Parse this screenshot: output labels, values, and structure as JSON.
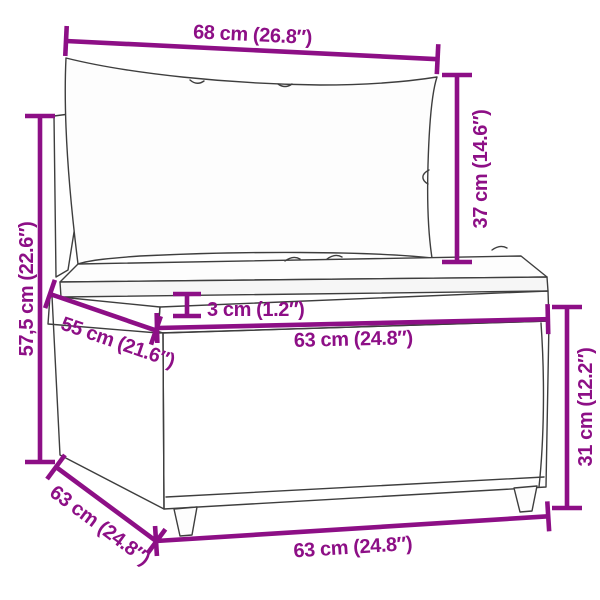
{
  "app": {
    "description": "Product dimension diagram of a poly-rattan sofa middle section with back and seat cushions"
  },
  "colors": {
    "dimension_accent": "#8d0f86",
    "sketch_line": "#3e3e3e",
    "background": "#ffffff"
  },
  "diagram": {
    "dimensions": {
      "top_width": "68 cm (26.8″)",
      "backrest_height": "37 cm (14.6″)",
      "total_height": "57,5 cm (22.6″)",
      "seat_cushion_thickness": "3 cm (1.2″)",
      "seat_depth": "55 cm (21.6″)",
      "seat_width": "63 cm (24.8″)",
      "base_height": "31 cm (12.2″)",
      "bottom_depth": "63 cm (24.8″)",
      "bottom_width": "63 cm (24.8″)"
    }
  }
}
